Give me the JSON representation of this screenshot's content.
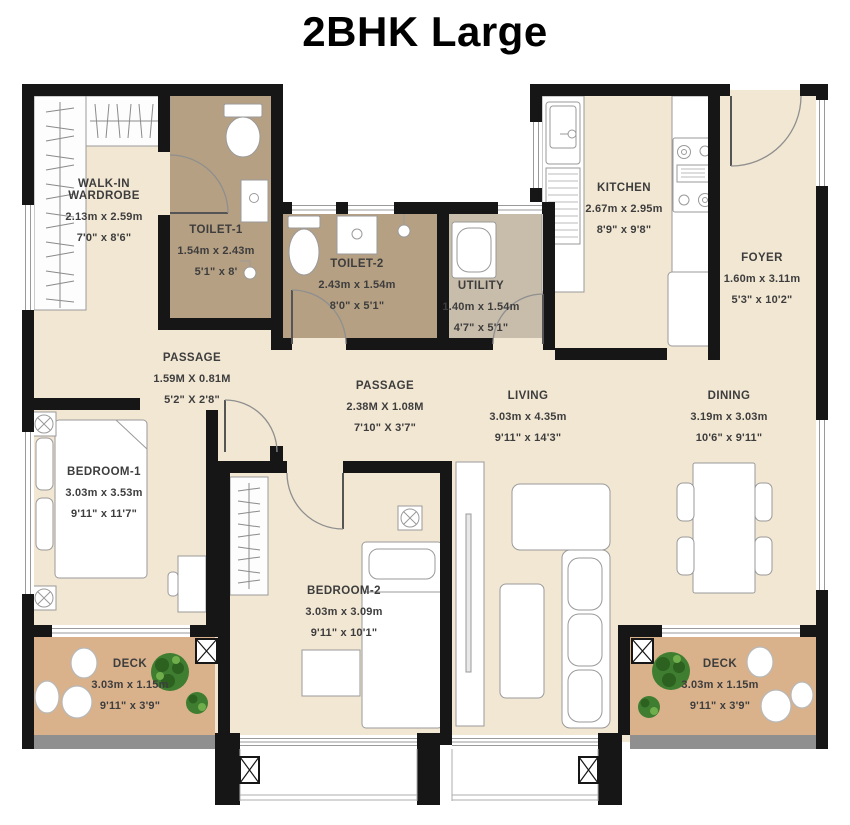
{
  "title": "2BHK Large",
  "rooms": {
    "wardrobe": {
      "name": "WALK-IN WARDROBE",
      "metric": "2.13m x 2.59m",
      "imperial": "7'0\" x 8'6\""
    },
    "toilet1": {
      "name": "TOILET-1",
      "metric": "1.54m x 2.43m",
      "imperial": "5'1\" x 8'"
    },
    "toilet2": {
      "name": "TOILET-2",
      "metric": "2.43m x 1.54m",
      "imperial": "8'0\" x 5'1\""
    },
    "utility": {
      "name": "UTILITY",
      "metric": "1.40m x 1.54m",
      "imperial": "4'7\" x 5'1\""
    },
    "kitchen": {
      "name": "KITCHEN",
      "metric": "2.67m x 2.95m",
      "imperial": "8'9\" x 9'8\""
    },
    "foyer": {
      "name": "FOYER",
      "metric": "1.60m x 3.11m",
      "imperial": "5'3\" x 10'2\""
    },
    "passage1": {
      "name": "PASSAGE",
      "metric": "1.59M X 0.81M",
      "imperial": "5'2\" X 2'8\""
    },
    "passage2": {
      "name": "PASSAGE",
      "metric": "2.38M X 1.08M",
      "imperial": "7'10\" X 3'7\""
    },
    "living": {
      "name": "LIVING",
      "metric": "3.03m x 4.35m",
      "imperial": "9'11\" x 14'3\""
    },
    "dining": {
      "name": "DINING",
      "metric": "3.19m x 3.03m",
      "imperial": "10'6\" x 9'11\""
    },
    "bedroom1": {
      "name": "BEDROOM-1",
      "metric": "3.03m x 3.53m",
      "imperial": "9'11\" x 11'7\""
    },
    "bedroom2": {
      "name": "BEDROOM-2",
      "metric": "3.03m x 3.09m",
      "imperial": "9'11\" x 10'1\""
    },
    "deckLeft": {
      "name": "DECK",
      "metric": "3.03m x 1.15m",
      "imperial": "9'11\" x 3'9\""
    },
    "deckRight": {
      "name": "DECK",
      "metric": "3.03m x 1.15m",
      "imperial": "9'11\" x 3'9\""
    }
  },
  "colors": {
    "wall": "#161616",
    "floor": "#f2e7d3",
    "toilet_floor": "#b5a083",
    "utility_floor": "#c8bdab",
    "deck_floor": "#d9b28c",
    "deck_edge": "#8f8f8f",
    "label_text": "#3d3d3d",
    "plant_green": "#3f7d31"
  }
}
